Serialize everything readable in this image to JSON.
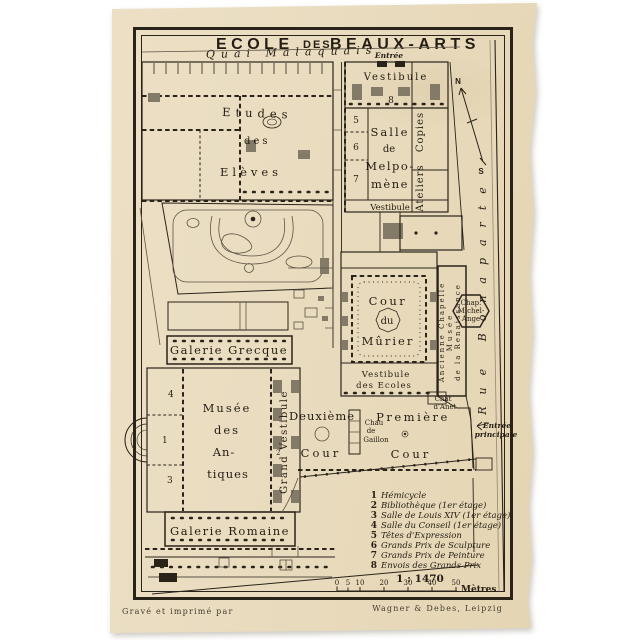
{
  "header": {
    "title_ecole": "ECOLE",
    "title_des": "DES",
    "title_beaux": "BEAUX-ARTS"
  },
  "streets": {
    "quai": "Quai Malaquais",
    "rue_bonaparte": "Rue Bonaparte"
  },
  "compass": {
    "n": "N",
    "s": "S"
  },
  "entrances": {
    "top": "Entrée",
    "principal_line1": "Entrée",
    "principal_line2": "principale"
  },
  "buildings": {
    "vestibule_top": "Vestibule",
    "room8": "8",
    "room5": "5",
    "room6": "6",
    "room7": "7",
    "room4": "4",
    "room1": "1",
    "room3": "3",
    "room2": "2",
    "salle_melpomene": [
      "Salle",
      "de",
      "Melpo-",
      "mène"
    ],
    "copies": "Copies",
    "ateliers": "Ateliers",
    "vestibule_mid": "Vestibule",
    "etudes": [
      "Etudes",
      "des",
      "Elèves"
    ],
    "cour_murier": [
      "Cour",
      "du",
      "Mûrier"
    ],
    "vestibule_ecoles": [
      "Vestibule",
      "des Ecoles"
    ],
    "chapelle_col1": "Ancienne Chapelle",
    "chapelle_col2": "Musée",
    "chapelle_col3": "de la Renaissance",
    "chap_michel": [
      "Chap.",
      "Michel-",
      "Ange"
    ],
    "galerie_grecque": "Galerie Grecque",
    "musee_antiques": [
      "Musée",
      "des",
      "An-",
      "tiques"
    ],
    "grand_vestibule": "Grand Vestibule",
    "galerie_romaine": "Galerie Romaine",
    "deuxieme_cour": [
      "Deuxième",
      "Cour"
    ],
    "premiere_cour": [
      "Première",
      "Cour"
    ],
    "chateau_gaillon": [
      "Chau",
      "de",
      "Gaillon"
    ],
    "chateau_anet": [
      "Chât",
      "d'Anet"
    ]
  },
  "legend": {
    "items": [
      {
        "n": "1",
        "t": "Hémicycle"
      },
      {
        "n": "2",
        "t": "Bibliothèque (1er étage)"
      },
      {
        "n": "3",
        "t": "Salle de Louis XIV (1er étage)"
      },
      {
        "n": "4",
        "t": "Salle du Conseil (1er étage)"
      },
      {
        "n": "5",
        "t": "Têtes d'Expression"
      },
      {
        "n": "6",
        "t": "Grands Prix de Sculpture"
      },
      {
        "n": "7",
        "t": "Grands Prix de Peinture"
      },
      {
        "n": "8",
        "t": "Envois des Grands Prix"
      }
    ],
    "scale": "1 : 1470",
    "ticks": [
      "0",
      "5",
      "10",
      "20",
      "30",
      "40",
      "50"
    ],
    "unit": "Mètres"
  },
  "credits": {
    "left": "Gravé et imprimé par",
    "right": "Wagner & Debes, Leipzig"
  },
  "colors": {
    "paper": "#e9dcbf",
    "ink": "#2a231a"
  }
}
